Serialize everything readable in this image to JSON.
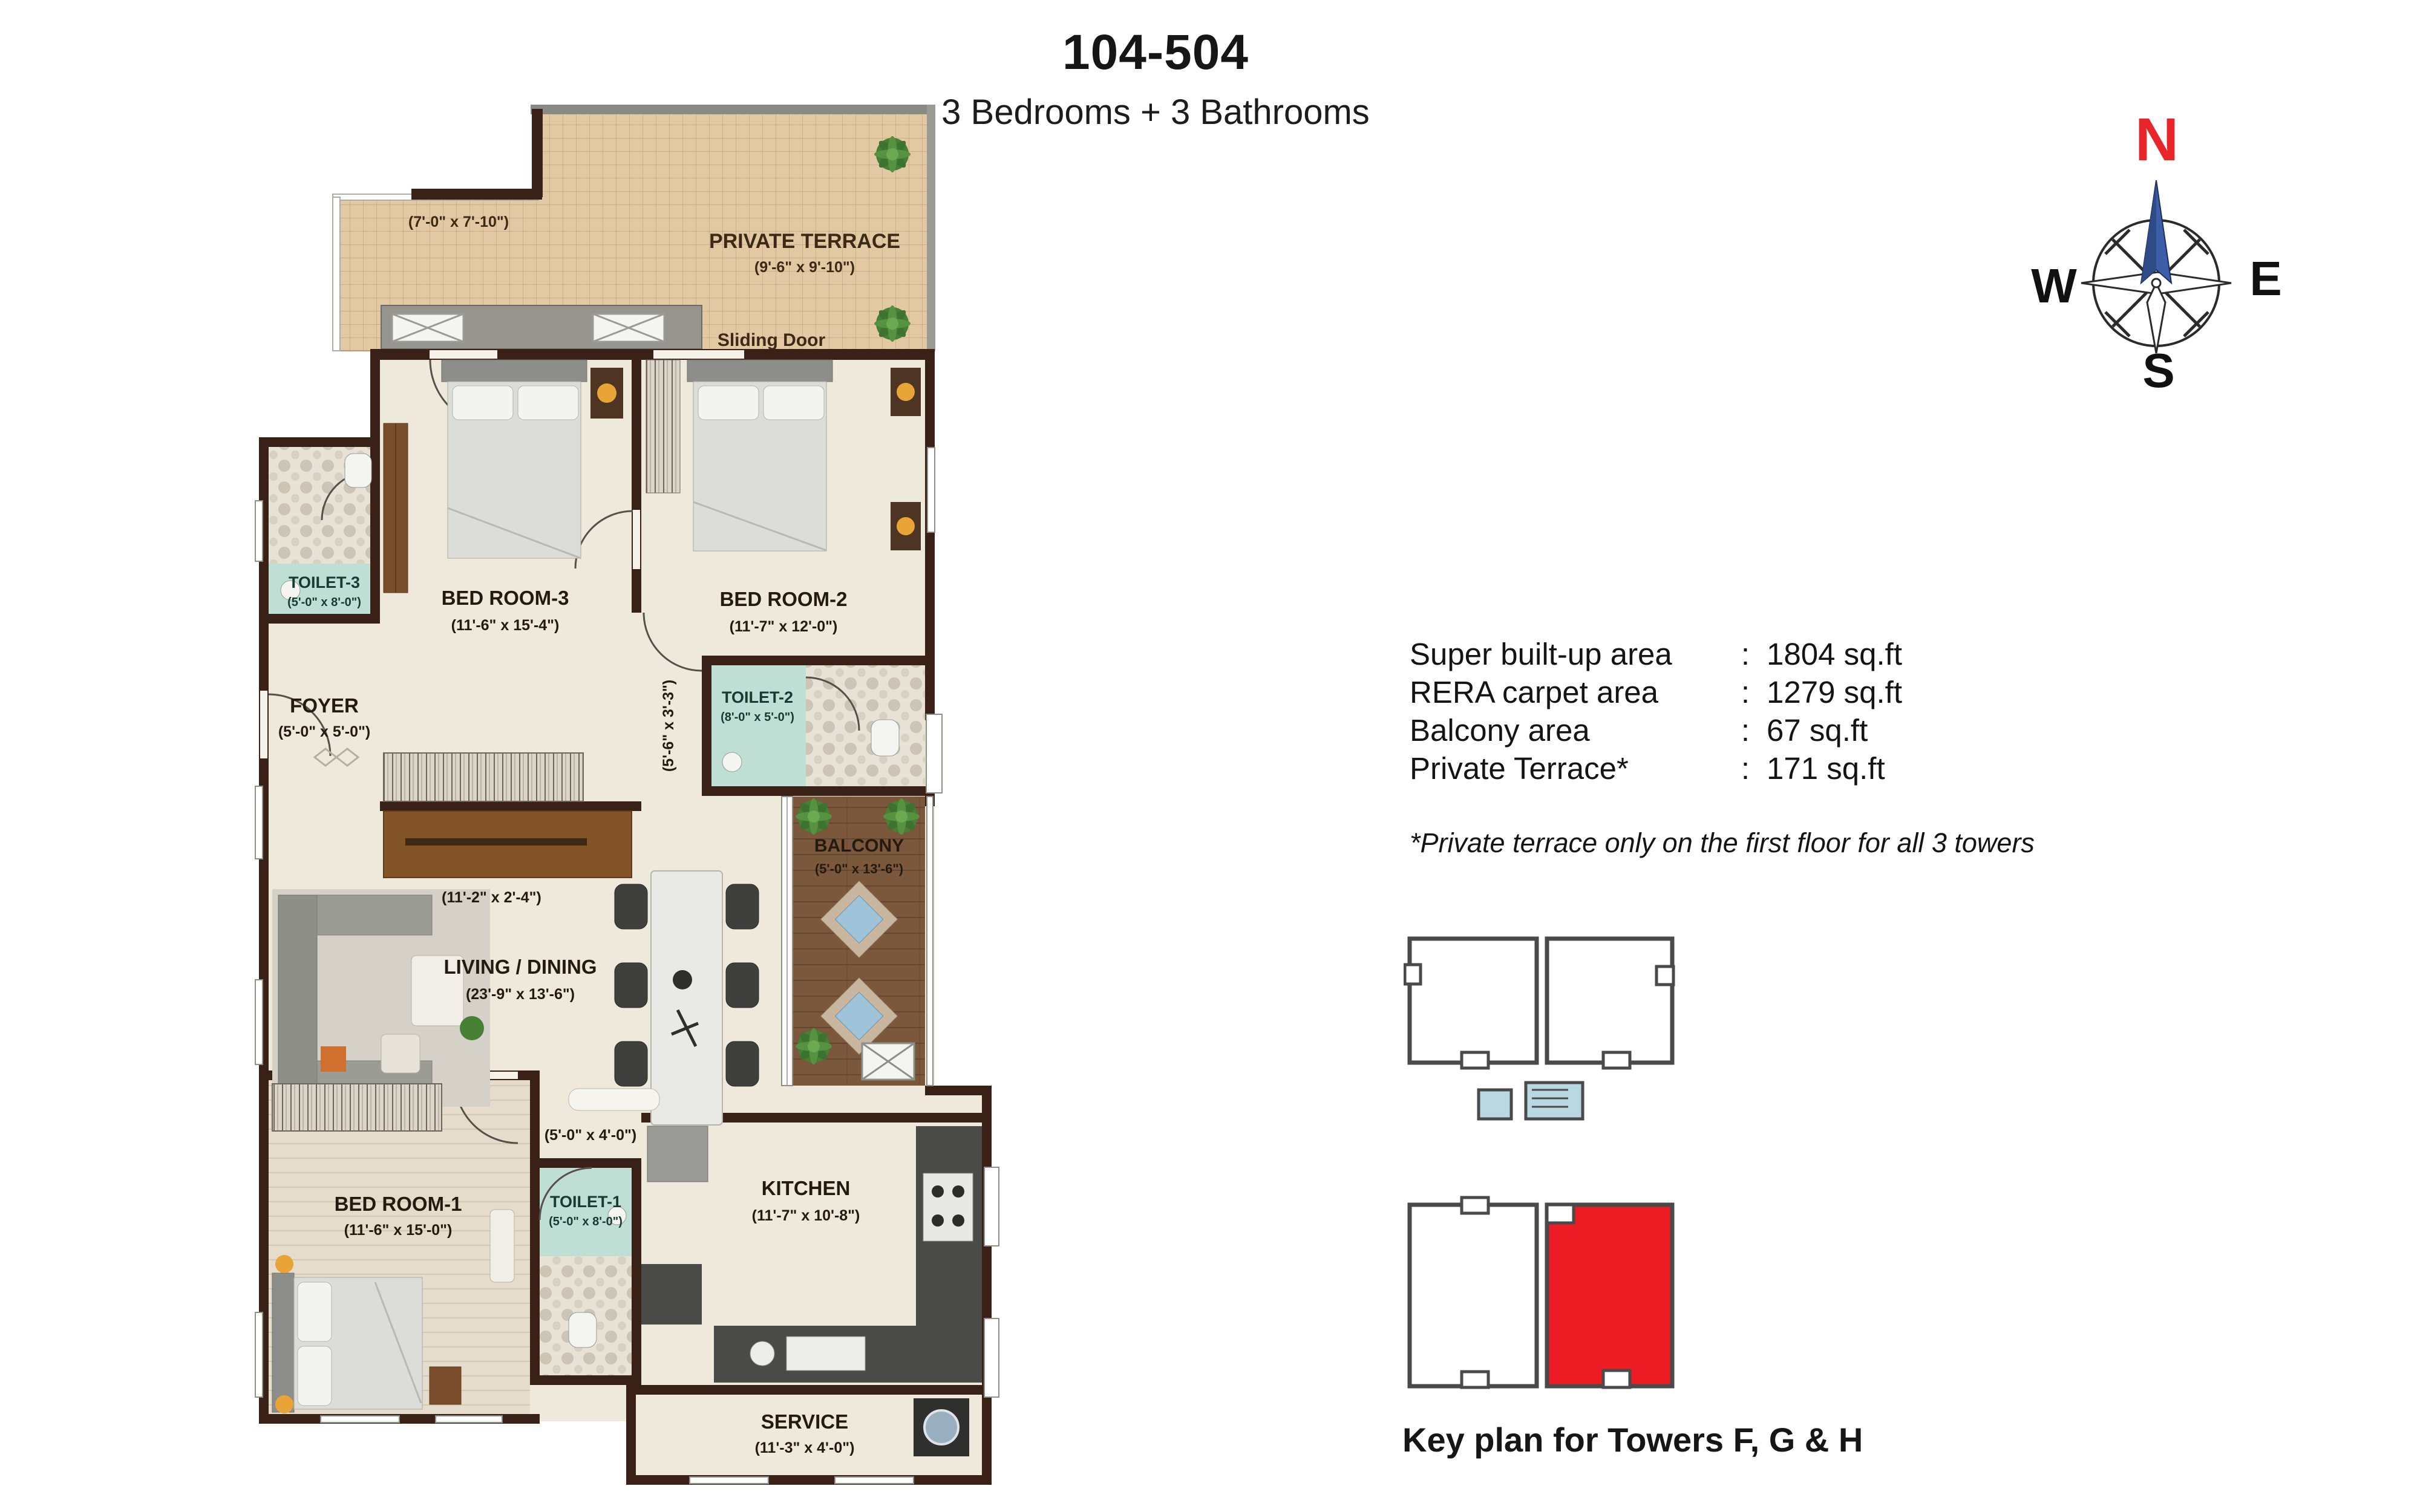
{
  "header": {
    "title": "104-504",
    "subtitle": "3 Bedrooms + 3 Bathrooms"
  },
  "compass": {
    "n": "N",
    "e": "E",
    "s": "S",
    "w": "W"
  },
  "areas": {
    "rows": [
      {
        "label": "Super built-up area",
        "sep": ":",
        "value": "1804 sq.ft"
      },
      {
        "label": "RERA carpet area",
        "sep": ":",
        "value": "1279 sq.ft"
      },
      {
        "label": "Balcony area",
        "sep": ":",
        "value": "67 sq.ft"
      },
      {
        "label": "Private Terrace*",
        "sep": ":",
        "value": "171 sq.ft"
      }
    ],
    "note": "*Private terrace only on the first floor for all 3 towers"
  },
  "keyplan": {
    "caption": "Key plan for Towers F, G & H"
  },
  "plan": {
    "terrace": {
      "name": "PRIVATE TERRACE",
      "dim": "(9'-6\" x 9'-10\")",
      "dim2": "(7'-0\" x 7'-10\")",
      "sliding_door": "Sliding Door"
    },
    "bedroom3": {
      "name": "BED ROOM-3",
      "dim": "(11'-6\" x 15'-4\")"
    },
    "bedroom2": {
      "name": "BED ROOM-2",
      "dim": "(11'-7\" x 12'-0\")"
    },
    "toilet3": {
      "name": "TOILET-3",
      "dim": "(5'-0\" x 8'-0\")"
    },
    "toilet2": {
      "name": "TOILET-2",
      "dim": "(8'-0\" x 5'-0\")"
    },
    "foyer": {
      "name": "FOYER",
      "dim": "(5'-0\" x 5'-0\")"
    },
    "living": {
      "name": "LIVING / DINING",
      "dim": "(23'-9\" x 13'-6\")"
    },
    "balcony": {
      "name": "BALCONY",
      "dim": "(5'-0\" x 13'-6\")"
    },
    "bedroom1": {
      "name": "BED ROOM-1",
      "dim": "(11'-6\" x 15'-0\")"
    },
    "toilet1": {
      "name": "TOILET-1",
      "dim": "(5'-0\" x 8'-0\")"
    },
    "kitchen": {
      "name": "KITCHEN",
      "dim": "(11'-7\" x 10'-8\")"
    },
    "service": {
      "name": "SERVICE",
      "dim": "(11'-3\" x 4'-0\")"
    },
    "wardrobe_dim": "(11'-2\" x 2'-4\")",
    "passage_dim": "(5'-0\" x 4'-0\")",
    "corridor_dim": "(5'-6\" x 3'-3\")"
  },
  "colors": {
    "wall": "#3A2117",
    "floor": "#EFE9DC",
    "teal": "#BFDED4",
    "terrace_tile": "#E2C9A4",
    "balcony_wood": "#7B573B",
    "keyplan_red": "#ED1C24",
    "compass_north_red": "#E8262A",
    "needle_blue": "#3D5FA9"
  }
}
